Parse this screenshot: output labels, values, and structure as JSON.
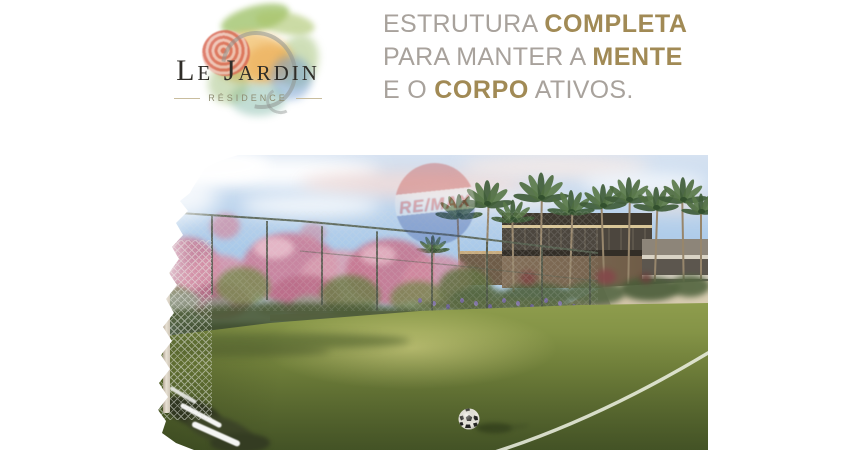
{
  "brand": {
    "name": "Le Jardin",
    "subtitle": "RÉSIDENCE"
  },
  "headline": {
    "line1_regular": "ESTRUTURA ",
    "line1_bold": "COMPLETA",
    "line2_regular": "PARA MANTER A ",
    "line2_bold": "MENTE",
    "line3_regular_a": "E O ",
    "line3_bold": "CORPO",
    "line3_regular_b": " ATIVOS."
  },
  "watermark": {
    "label": "RE/MAX"
  },
  "colors": {
    "accent_gold": "#a18a55",
    "headline_muted": "#a8a29c",
    "logo_ink": "#2f2d28",
    "residence_olive": "#8e8c72",
    "remax_red": "#cf3430",
    "remax_blue": "#3853a0",
    "sky_blue": "#a9c9e9",
    "grass_green": "#93a150",
    "bloom_pink": "#cb7f9a"
  }
}
